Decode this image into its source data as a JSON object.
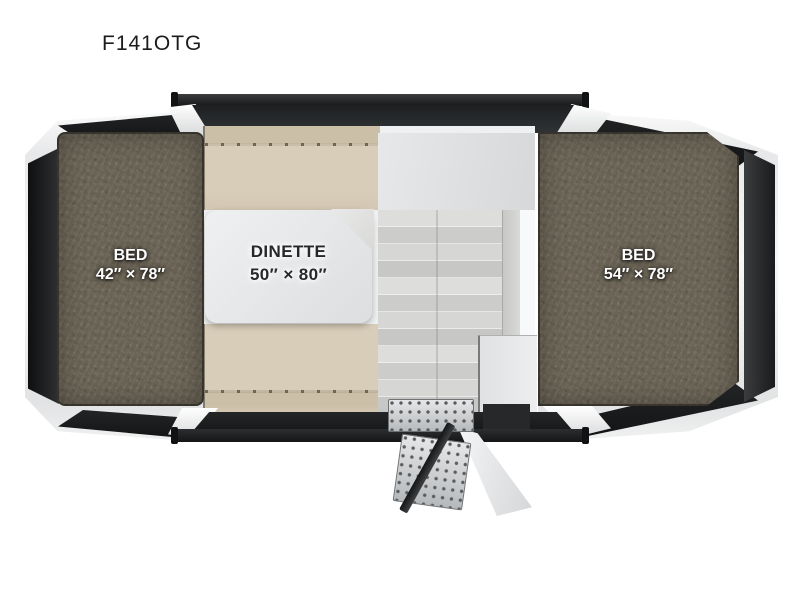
{
  "title": "F141OTG",
  "floorplan": {
    "model": "F141OTG",
    "left_bed": {
      "name": "BED",
      "size": "42″ × 78″"
    },
    "right_bed": {
      "name": "BED",
      "size": "54″ × 78″"
    },
    "dinette": {
      "name": "DINETTE",
      "size": "50″ × 80″"
    },
    "colors": {
      "background": "#ffffff",
      "mattress": "#6b6456",
      "bench_cushion": "#d8cdb9",
      "table": "#e4e6e7",
      "shell_dark": "#1b1d1f",
      "shell_white": "#f4f5f6",
      "floor_plank": "#d6d6d4",
      "label_text_light": "#ffffff",
      "label_text_dark": "#26282a"
    }
  }
}
